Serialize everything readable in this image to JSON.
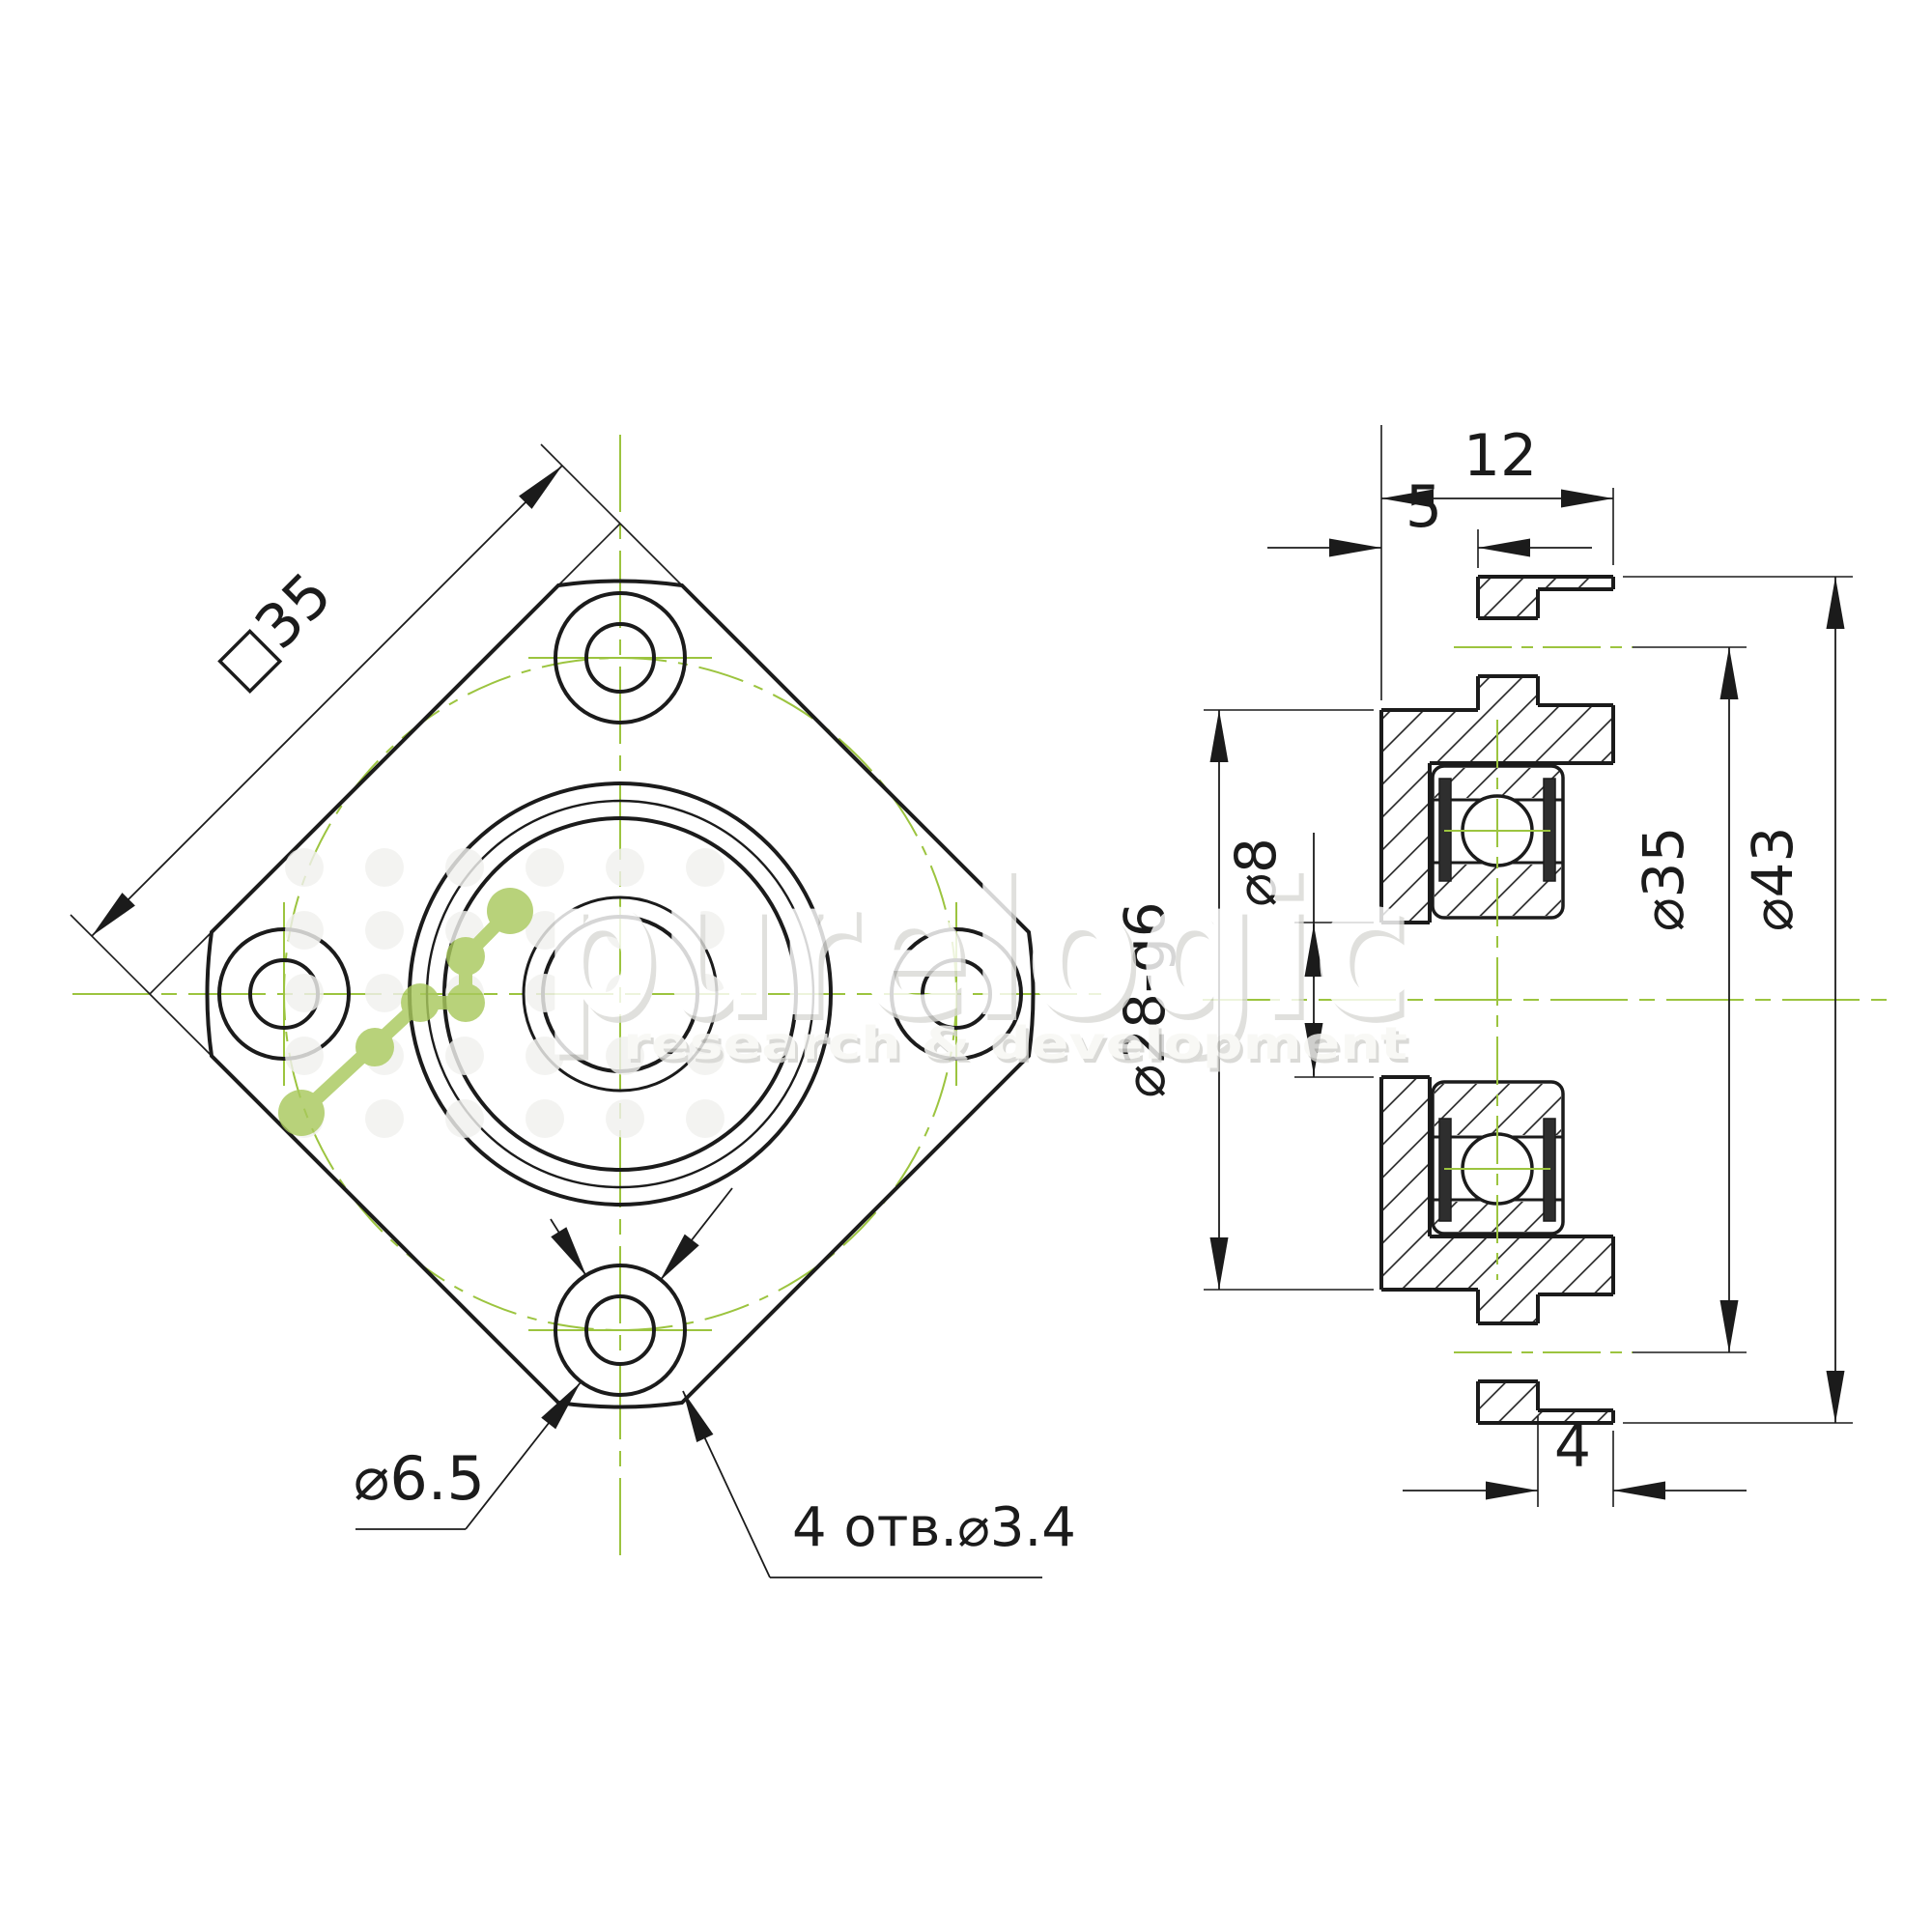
{
  "drawing": {
    "type": "technical-drawing",
    "part": "flange bearing mount with ball bearing, two-view GOST drawing",
    "colors": {
      "line": "#1b1b1b",
      "centerline_green": "#9cc43f",
      "logo_green": "#a9c95d",
      "watermark_gray": "#d9d9d5"
    },
    "front_view": {
      "square_size_label": "□35",
      "counterbore_label": "⌀6.5",
      "holes_label": "4 отв.⌀3.4"
    },
    "side_view": {
      "overall_width_label": "12",
      "pilot_length_label": "5",
      "pilot_diameter_label": "⌀28-g6",
      "bore_diameter_label": "⌀8",
      "bolt_circle_label": "⌀35",
      "flange_diameter_label": "⌀43",
      "counterbore_depth_label": "4"
    },
    "watermark": {
      "brand": "purelogic",
      "tagline": "research & development"
    }
  }
}
